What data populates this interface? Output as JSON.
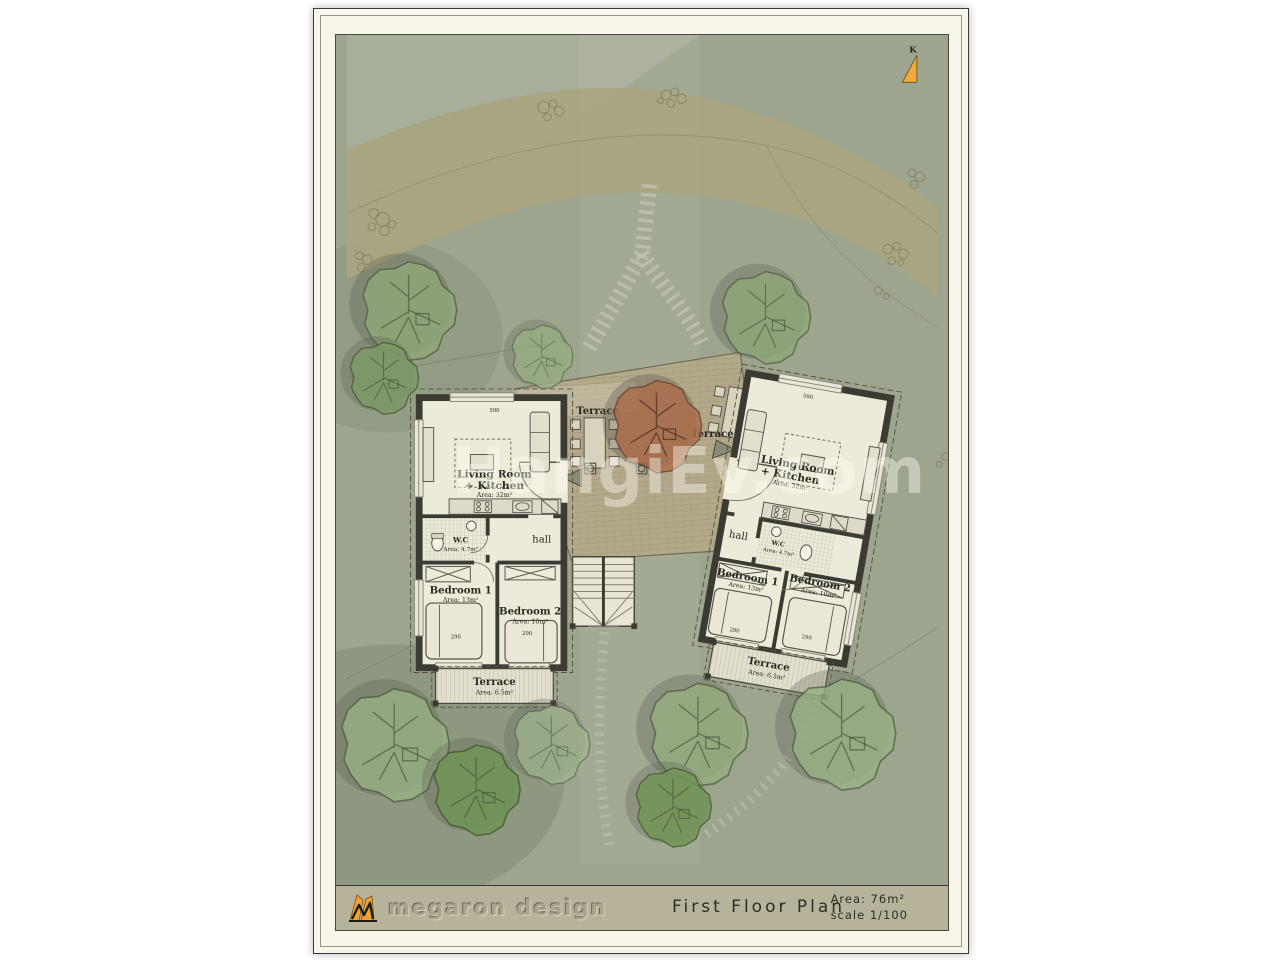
{
  "colors": {
    "paper": "#f8f5ea",
    "site_ground": "#9da58e",
    "road": "#aaa580",
    "deck_wood": "#b2a88a",
    "wall": "#3b3a33",
    "room_floor": "#ecead9",
    "tree_green": "#8fa878",
    "tree_red": "#ad6b4a",
    "north_arrow_orange": "#f2a93b"
  },
  "compass": {
    "label": "K"
  },
  "watermark": {
    "text": "HangiEv.com"
  },
  "site": {
    "deck": {
      "left_label": "Terrace",
      "right_label": "Terrace"
    }
  },
  "units": [
    {
      "id": "left-unit",
      "living": {
        "name": "Living Room",
        "name2": "+ Kitchen",
        "area": "Area: 32m²"
      },
      "wc": {
        "name": "W.C",
        "area": "Area: 4.7m²"
      },
      "hall": {
        "name": "hall"
      },
      "bedroom1": {
        "name": "Bedroom 1",
        "area": "Area: 13m²"
      },
      "bedroom2": {
        "name": "Bedroom 2",
        "area": "Area: 10m²"
      },
      "terrace": {
        "name": "Terrace",
        "area": "Area: 6.5m²"
      },
      "dims": {
        "top": "590",
        "bed1": "290",
        "bed2": "290"
      }
    },
    {
      "id": "right-unit",
      "living": {
        "name": "Living Room",
        "name2": "+ Kitchen",
        "area": "Area: 32m²"
      },
      "wc": {
        "name": "W.C",
        "area": "Area: 4.7m²"
      },
      "hall": {
        "name": "hall"
      },
      "bedroom1": {
        "name": "Bedroom 1",
        "area": "Area: 13m²"
      },
      "bedroom2": {
        "name": "Bedroom 2",
        "area": "Area: 10m²"
      },
      "terrace": {
        "name": "Terrace",
        "area": "Area: 6.5m²"
      },
      "dims": {
        "top": "590",
        "bed1": "290",
        "bed2": "290"
      }
    }
  ],
  "title_block": {
    "brand": "megaron design",
    "title": "First Floor Plan",
    "area": "Area: 76m²",
    "scale": "scale 1/100"
  }
}
